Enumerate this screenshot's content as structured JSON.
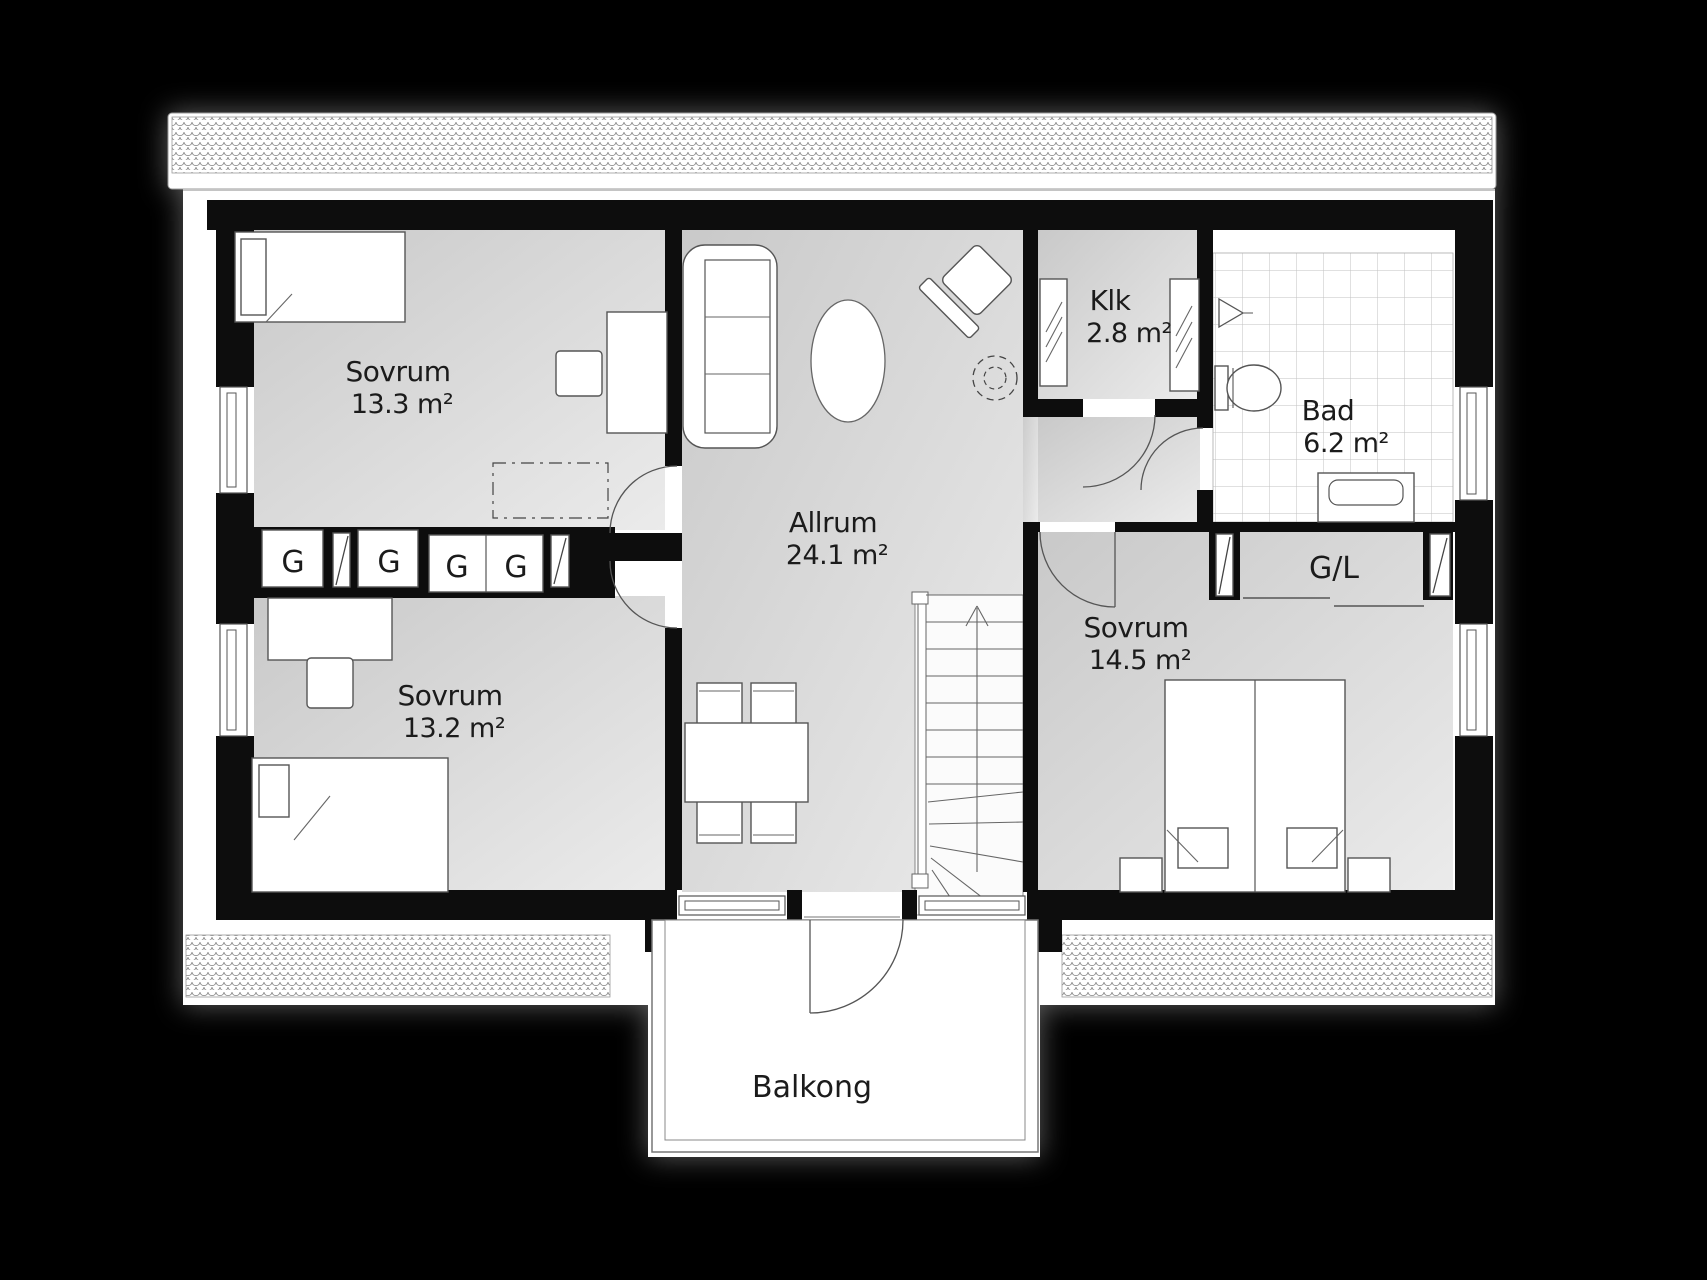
{
  "plan_title": "Floor plan – upper floor",
  "rooms": [
    {
      "name": "Sovrum",
      "area": "13.3 m²"
    },
    {
      "name": "Sovrum",
      "area": "13.2 m²"
    },
    {
      "name": "Allrum",
      "area": "24.1 m²"
    },
    {
      "name": "Klk",
      "area": "2.8 m²"
    },
    {
      "name": "Bad",
      "area": "6.2 m²"
    },
    {
      "name": "Sovrum",
      "area": "14.5 m²"
    }
  ],
  "closets": {
    "gl": "G/L",
    "g": [
      "G",
      "G",
      "G",
      "G"
    ]
  },
  "balcony": {
    "label": "Balkong"
  },
  "colors": {
    "background": "#000000",
    "wall": "#0d0d0d",
    "floor_dark": "#cccccc",
    "floor_light": "#ebebeb",
    "paper": "#ffffff",
    "outline": "#555555"
  }
}
